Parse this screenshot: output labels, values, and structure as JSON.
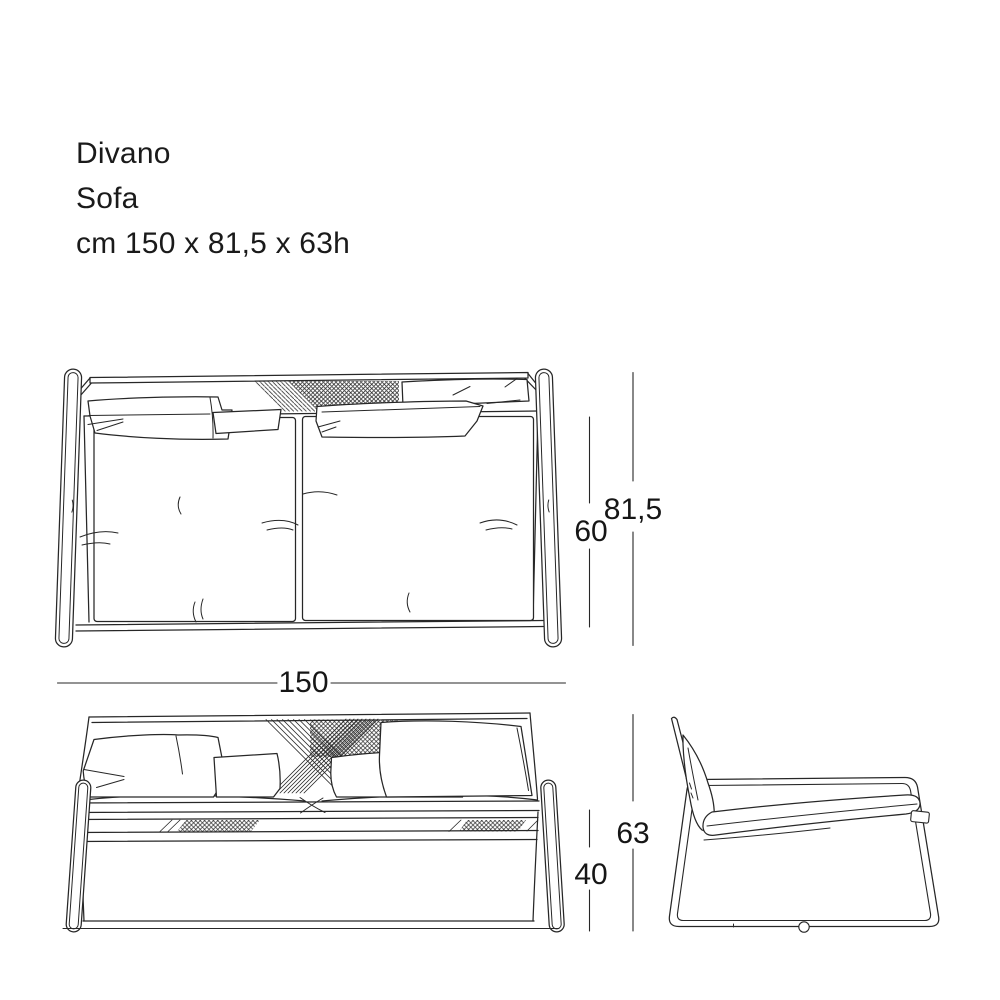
{
  "title": {
    "line1": "Divano",
    "line2": "Sofa",
    "line3": "cm 150 x 81,5 x 63h"
  },
  "dimension_labels": {
    "top_view_inner_depth": "60",
    "top_view_total_depth": "81,5",
    "width": "150",
    "front_view_total_height": "63",
    "front_view_seat_height": "40"
  },
  "colors": {
    "background": "#ffffff",
    "line": "#272727",
    "text": "#1a1a1a"
  }
}
